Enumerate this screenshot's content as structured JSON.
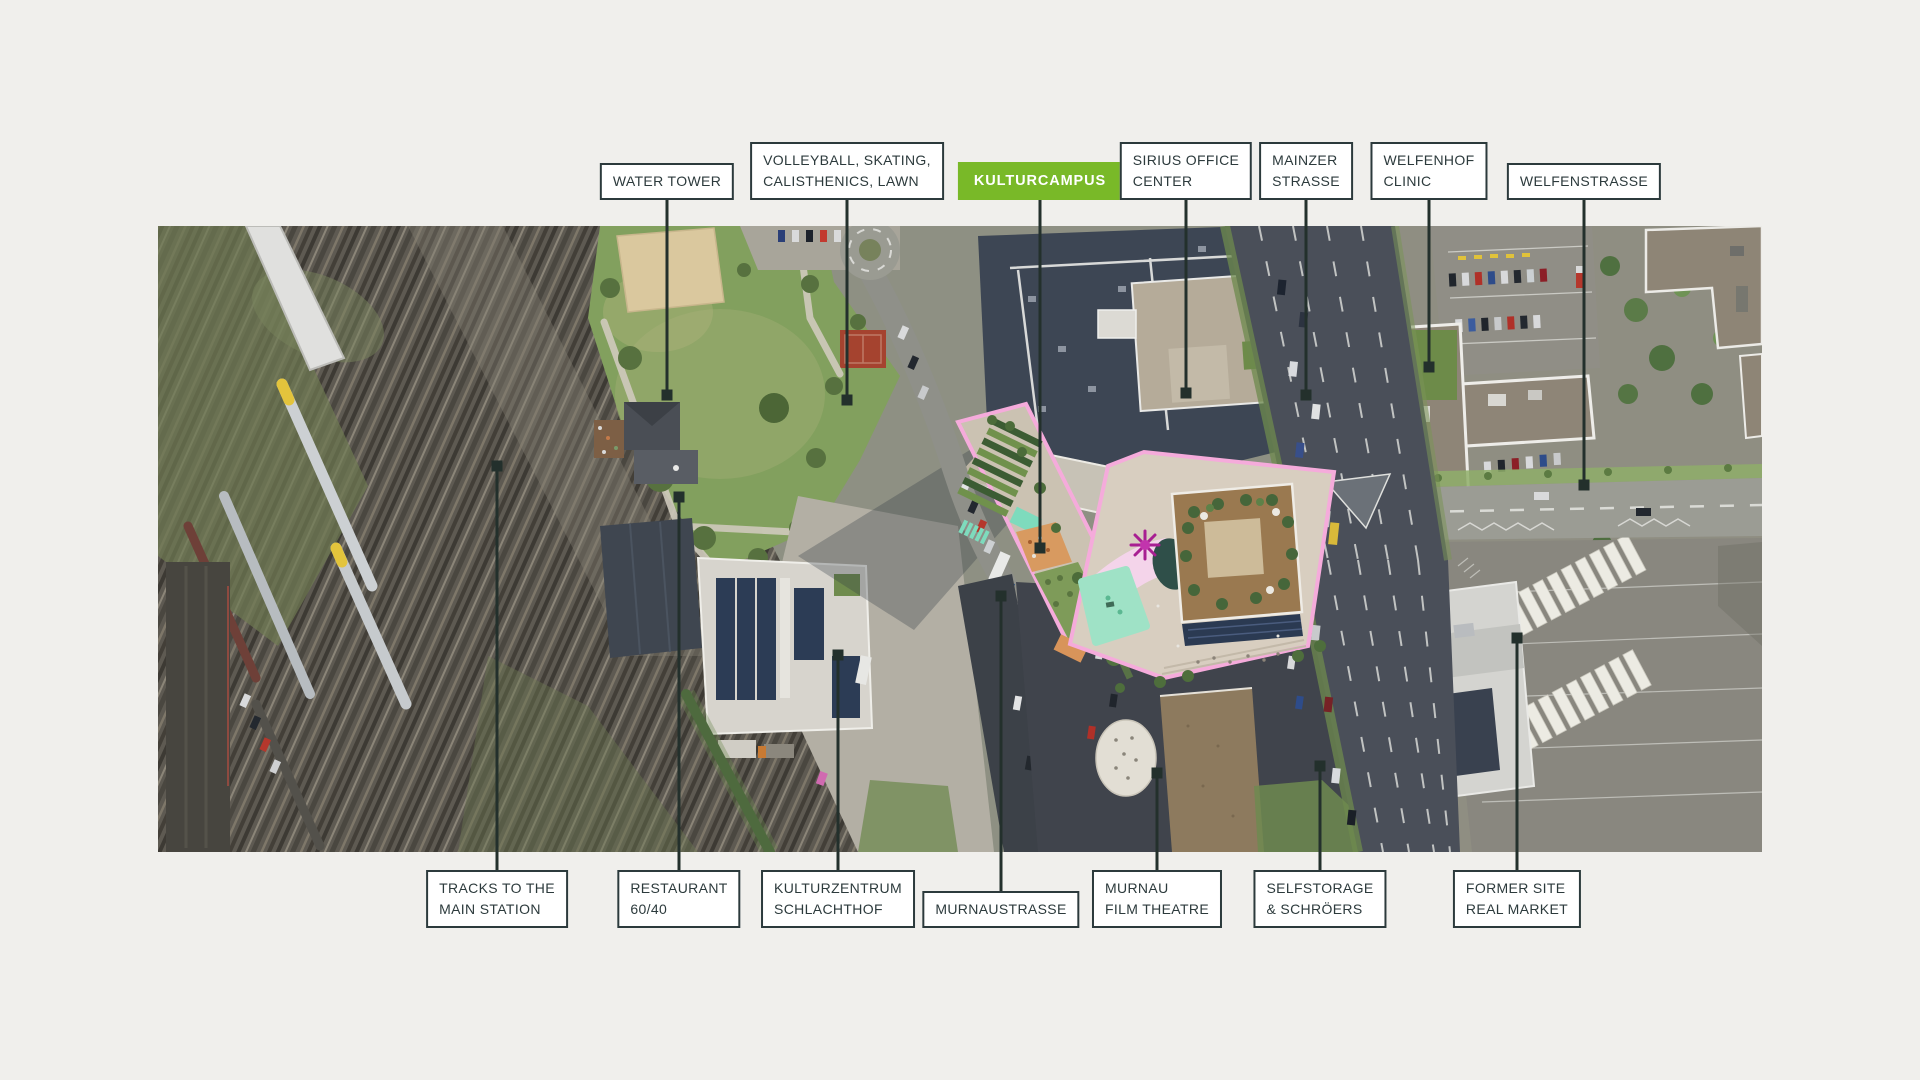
{
  "style": {
    "background": "#f0efec",
    "ink": "#2c3a3c",
    "box_background": "#ffffff",
    "accent_green": "#79b928",
    "accent_green_text": "#ffffff",
    "leader_line": "#23302c"
  },
  "map": {
    "type": "aerial-photo",
    "x": 158,
    "y": 226,
    "width": 1604,
    "height": 626
  },
  "labels": {
    "top": [
      {
        "id": "water-tower",
        "text": "WATER TOWER",
        "x": 667,
        "tip_y": 395,
        "green": false
      },
      {
        "id": "volleyball-area",
        "text": "VOLLEYBALL, SKATING,\nCALISTHENICS, LAWN",
        "x": 847,
        "tip_y": 400,
        "green": false
      },
      {
        "id": "kulturcampus",
        "text": "KULTURCAMPUS",
        "x": 1040,
        "tip_y": 548,
        "green": true
      },
      {
        "id": "sirius-office-center",
        "text": "SIRIUS OFFICE\nCENTER",
        "x": 1186,
        "tip_y": 393,
        "green": false
      },
      {
        "id": "mainzer-strasse",
        "text": "MAINZER\nSTRASSE",
        "x": 1306,
        "tip_y": 395,
        "green": false
      },
      {
        "id": "welfenhof-clinic",
        "text": "WELFENHOF\nCLINIC",
        "x": 1429,
        "tip_y": 367,
        "green": false
      },
      {
        "id": "welfenstrasse",
        "text": "WELFENSTRASSE",
        "x": 1584,
        "tip_y": 485,
        "green": false
      }
    ],
    "bottom": [
      {
        "id": "tracks-to-main-station",
        "text": "TRACKS TO THE\nMAIN STATION",
        "x": 497,
        "tip_y": 466
      },
      {
        "id": "restaurant-60-40",
        "text": "RESTAURANT\n60/40",
        "x": 679,
        "tip_y": 497
      },
      {
        "id": "kulturzentrum-schlachthof",
        "text": "KULTURZENTRUM\nSCHLACHTHOF",
        "x": 838,
        "tip_y": 655
      },
      {
        "id": "murnaustrasse",
        "text": "MURNAUSTRASSE",
        "x": 1001,
        "tip_y": 596
      },
      {
        "id": "murnau-film-theatre",
        "text": "MURNAU\nFILM THEATRE",
        "x": 1157,
        "tip_y": 773
      },
      {
        "id": "selfstorage-schroeers",
        "text": "SELFSTORAGE\n& SCHRÖERS",
        "x": 1320,
        "tip_y": 766
      },
      {
        "id": "former-site-real-market",
        "text": "FORMER SITE\nREAL MARKET",
        "x": 1517,
        "tip_y": 638
      }
    ],
    "top_box_bottom_y": 200,
    "bottom_box_bottom_y": 928
  }
}
